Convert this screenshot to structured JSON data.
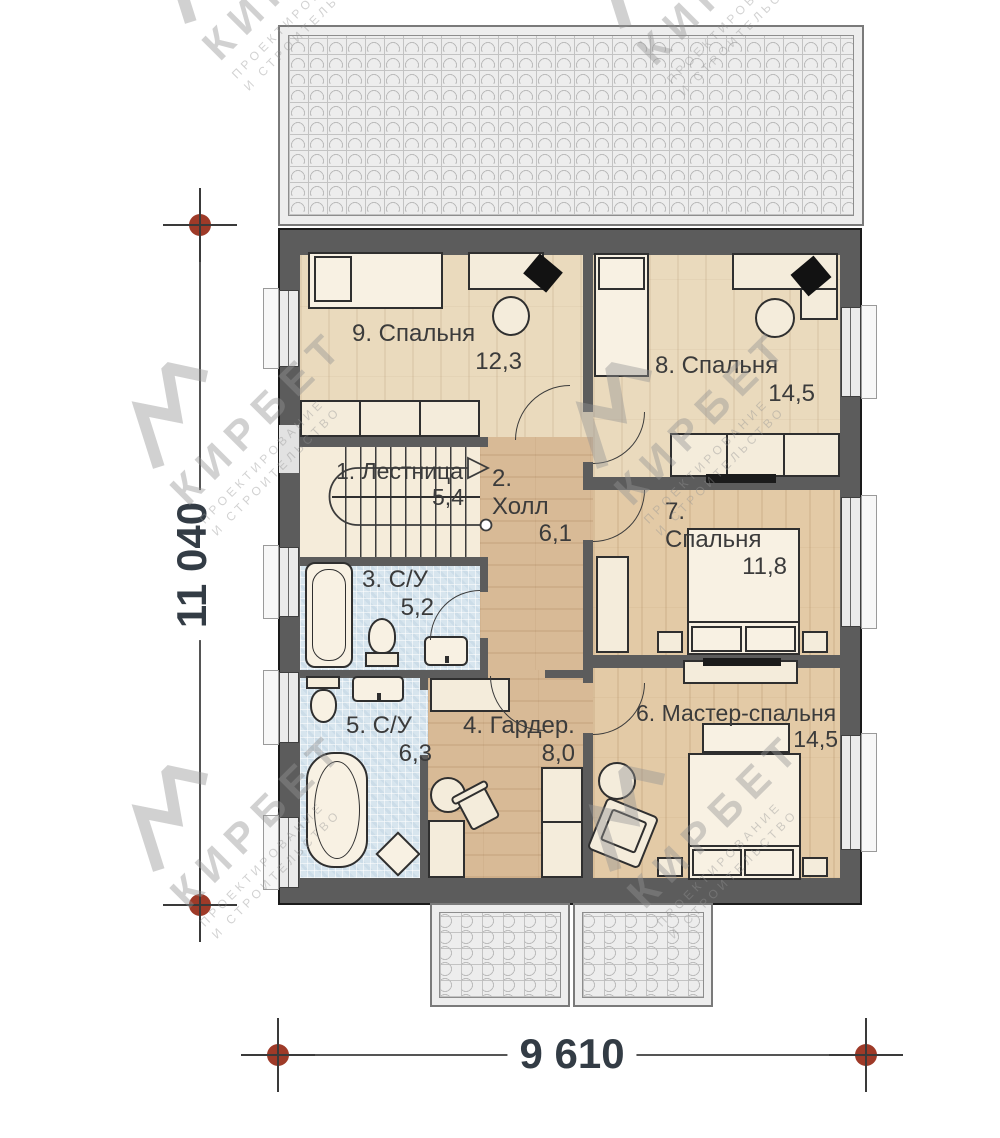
{
  "dimensions": {
    "height": "11 040",
    "width": "9 610"
  },
  "rooms": {
    "stairs": {
      "name": "1. Лестница",
      "area": "5,4"
    },
    "hall": {
      "name": "2. Холл",
      "area": "6,1"
    },
    "bath3": {
      "name": "3. С/У",
      "area": "5,2"
    },
    "wardrobe": {
      "name": "4. Гардер.",
      "area": "8,0"
    },
    "bath5": {
      "name": "5. С/У",
      "area": "6,3"
    },
    "master": {
      "name": "6. Мастер-спальня",
      "area": "14,5"
    },
    "bedroom7": {
      "name": "7. Спальня",
      "area": "11,8"
    },
    "bedroom8": {
      "name": "8. Спальня",
      "area": "14,5"
    },
    "bedroom9": {
      "name": "9. Спальня",
      "area": "12,3"
    }
  },
  "watermark": {
    "brand": "КИРБЕТ",
    "line1": "ПРОЕКТИРОВАНИЕ",
    "line2": "И СТРОИТЕЛЬСТВО"
  },
  "colors": {
    "wall": "#5c5c5c",
    "marker": "#9e3a28",
    "wood_light": "#eadabd",
    "wood_mid": "#e3caa6",
    "wood_dark": "#d8ba96",
    "tile": "#d7e5ee"
  }
}
